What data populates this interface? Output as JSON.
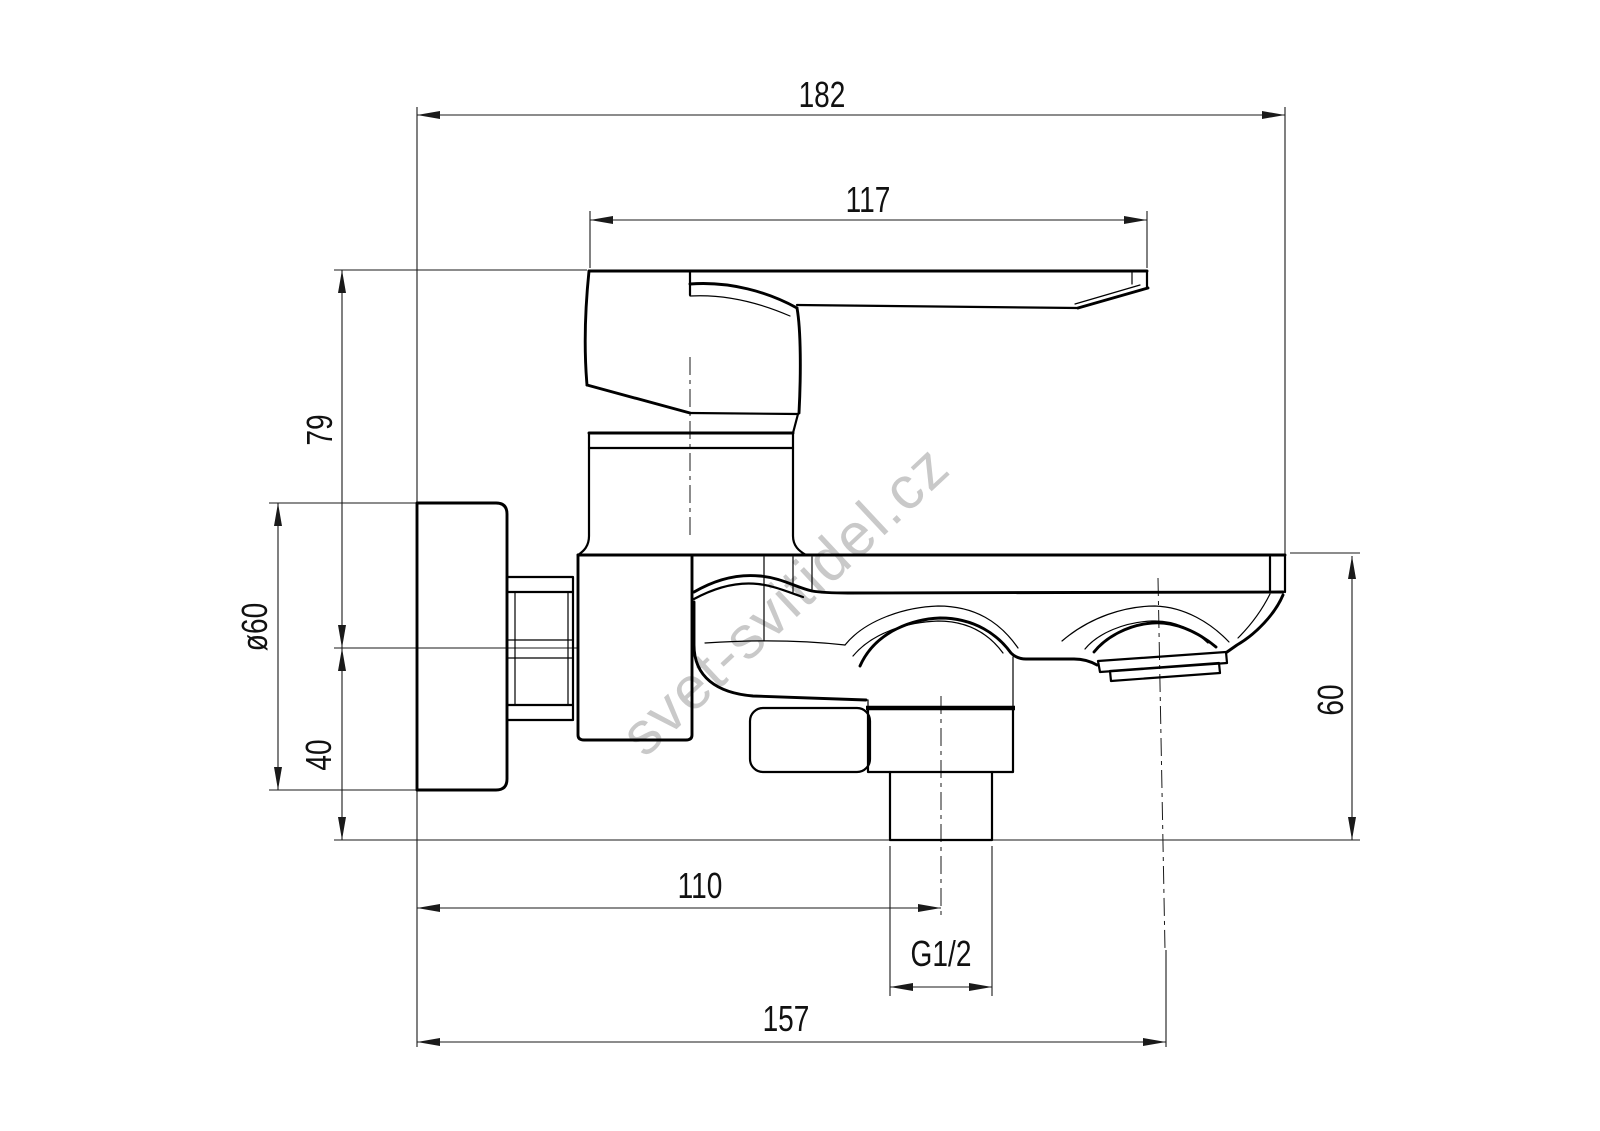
{
  "drawing": {
    "type": "technical-dimension-drawing",
    "subject": "wall-mounted single-lever bath mixer faucet, side view",
    "units_implied": "mm"
  },
  "dimensions": {
    "total_depth": "182",
    "lever_length": "117",
    "top_to_axis_height": "79",
    "flange_diameter": "ø60",
    "axis_to_flange_bottom": "40",
    "spout_body_height": "60",
    "wall_to_shower_outlet": "110",
    "shower_outlet_thread": "G1/2",
    "wall_to_spout_outlet": "157"
  },
  "watermark": {
    "text": "svet-svitidel.cz",
    "color": "#c9c9c9"
  },
  "colors": {
    "background": "#ffffff",
    "line": "#000000",
    "dimension_text": "#111111"
  }
}
